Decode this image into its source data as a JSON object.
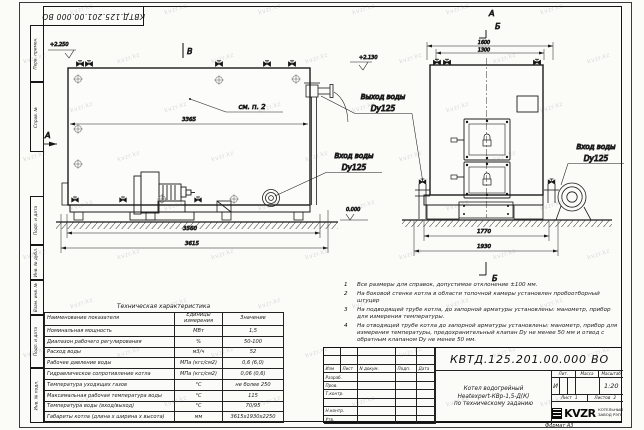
{
  "page": {
    "stamp_top": "КВТД.125.201.00.000 ВО",
    "format_label": "Формат А3"
  },
  "watermark": {
    "text": "kvzr.kz"
  },
  "sidebar": {
    "fields": [
      "Перв. примен.",
      "Справ. №",
      "Подп. и дата",
      "Инв. № дубл.",
      "Взам. инв. №",
      "Подп. и дата",
      "Инв. № подл."
    ]
  },
  "drawing": {
    "side_view": {
      "label_top": "В",
      "label_left": "А",
      "see_note": "см. п. 2",
      "elev_top": "+2.250",
      "elev_outlet": "+2.130",
      "elev_zero": "0.000",
      "dim_width_body": "3365",
      "dim_width_base": "3560",
      "dim_width_total": "3615",
      "outlet_label": "Выход воды",
      "outlet_dn": "Dy125",
      "inlet_label": "Вход воды",
      "inlet_dn": "Dy125"
    },
    "front_view": {
      "label_a": "А",
      "label_b": "Б",
      "label_b_bottom": "Б",
      "dim_top_outer": "1600",
      "dim_top_inner": "1300",
      "dim_bottom_inner": "1770",
      "dim_bottom_outer": "1930",
      "inlet_label": "Вход воды",
      "inlet_dn": "Dy125"
    }
  },
  "tech_table": {
    "title": "Техническая характеристика",
    "headers": [
      "Наименование показателя",
      "Единицы измерения",
      "Значение"
    ],
    "rows": [
      [
        "Номинальная мощность",
        "МВт",
        "1,5"
      ],
      [
        "Диапазон рабочего регулирования",
        "%",
        "50-100"
      ],
      [
        "Расход воды",
        "м3/ч",
        "52"
      ],
      [
        "Рабочее давление воды",
        "МПа (кгс/см2)",
        "0,6 (6,0)"
      ],
      [
        "Гидравлическое сопротивление котла",
        "МПа (кгс/см2)",
        "0,06 (0,6)"
      ],
      [
        "Температура уходящих газов",
        "°С",
        "не более 250"
      ],
      [
        "Максимальная рабочая температура воды",
        "°С",
        "115"
      ],
      [
        "Температура воды (вход/выход)",
        "°С",
        "70/95"
      ],
      [
        "Габариты котла (длина х ширина х высота)",
        "мм",
        "3615х1930х2250"
      ]
    ]
  },
  "notes": {
    "items": [
      {
        "num": "1",
        "text": "Все размеры для справок, допустимое отклонение ±100 мм."
      },
      {
        "num": "2",
        "text": "На боковой стенке котла в области топочной камеры установлен пробоотборный штуцер"
      },
      {
        "num": "3",
        "text": "На подводящей трубе котла, до запорной арматуры установлены: манометр, прибор для измерения температуры."
      },
      {
        "num": "4",
        "text": "На отводящей трубе котла до запорной арматуры установлены: манометр, прибор для измерения температуры, предохранительный клапан Dу не менее 50 мм и отвод с обратным клапаном Dу не менее 50 мм."
      }
    ]
  },
  "title_block": {
    "doc_number": "КВТД.125.201.00.000  ВО",
    "title_line1": "Котел водогрейный",
    "title_line2": "Heatexpert-КВр-1,5-Д(К)",
    "title_line3": "по техническому заданию",
    "header_cols": [
      "Изм",
      "Лист",
      "N докум.",
      "Подп.",
      "Дата"
    ],
    "rows": [
      "Разраб.",
      "Пров.",
      "Т.контр.",
      "",
      "Н.контр.",
      "Утв."
    ],
    "lit_label": "Лит.",
    "lit_value": "И",
    "mass_label": "Масса",
    "scale_label": "Масштаб",
    "scale_value": "1:20",
    "sheet_label": "Лист",
    "sheet_value": "1",
    "sheets_label": "Листов",
    "sheets_value": "2",
    "company_logo": "KVZR",
    "company_name1": "КОТЕЛЬНЫЙ",
    "company_name2": "ЗАВОД РЭП"
  }
}
